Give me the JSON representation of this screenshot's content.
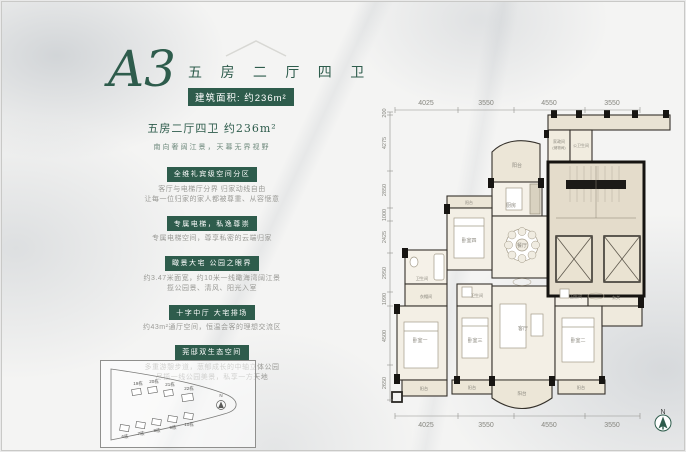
{
  "header": {
    "plan_code": "A3",
    "title": "五 房 二 厅 四 卫",
    "area_label": "建筑面积: 约236m²"
  },
  "intro": {
    "headline": "五房二厅四卫 约236m²",
    "subline": "南向奢阔江景，天幕无界视野"
  },
  "sections": [
    {
      "badge": "全维礼宾级空间分区",
      "lines": [
        "客厅与电梯厅分界 归家动线自由",
        "让每一位归家的家人都被尊重、从容惬意"
      ]
    },
    {
      "badge": "专属电梯，私逸尊崇",
      "lines": [
        "专属电梯空间，尊享私密的云端归家"
      ]
    },
    {
      "badge": "瞰景大宅 公园之眼界",
      "lines": [
        "约3.47米面宽，约10米一线瞰海湾阔江景",
        "揽公园景、清风、阳光入室"
      ]
    },
    {
      "badge": "十字中厅 大宅排场",
      "lines": [
        "约43m²通厅空间，恒温会客的理想交流区"
      ]
    },
    {
      "badge": "莞邸双生态空间",
      "lines": [
        "多重游憩步道，葱郁成长的中轴立体公园",
        "尽揽一线公园美景，私享一方天地"
      ]
    }
  ],
  "site_map": {
    "buildings_top": [
      "19栋",
      "20栋",
      "21栋",
      "22栋"
    ],
    "buildings_bottom": [
      "6栋",
      "7栋",
      "8栋",
      "9栋",
      "10栋"
    ],
    "north_label": "N"
  },
  "plan": {
    "dims_top": [
      "4025",
      "3550",
      "4550",
      "3550"
    ],
    "dims_bottom": [
      "4025",
      "3550",
      "4550",
      "3550"
    ],
    "dims_left": [
      "200",
      "4275",
      "2850",
      "1000",
      "2425",
      "2950",
      "1090",
      "4500",
      "2650"
    ],
    "rooms": {
      "balcony": "阳台",
      "kitchen": "厨房",
      "dining": "餐厅",
      "living": "客厅",
      "bed1": "卧室一",
      "bed2": "卧室二",
      "bed3": "卧室三",
      "bed4": "卧室四",
      "closet": "衣帽间",
      "bath": "卫生间",
      "service": "家政间",
      "service_sub": "(储物间)",
      "public_bath": "公卫生间",
      "foyer": "玄关"
    },
    "north_label": "N"
  },
  "colors": {
    "accent_green": "#2e5c4c"
  }
}
